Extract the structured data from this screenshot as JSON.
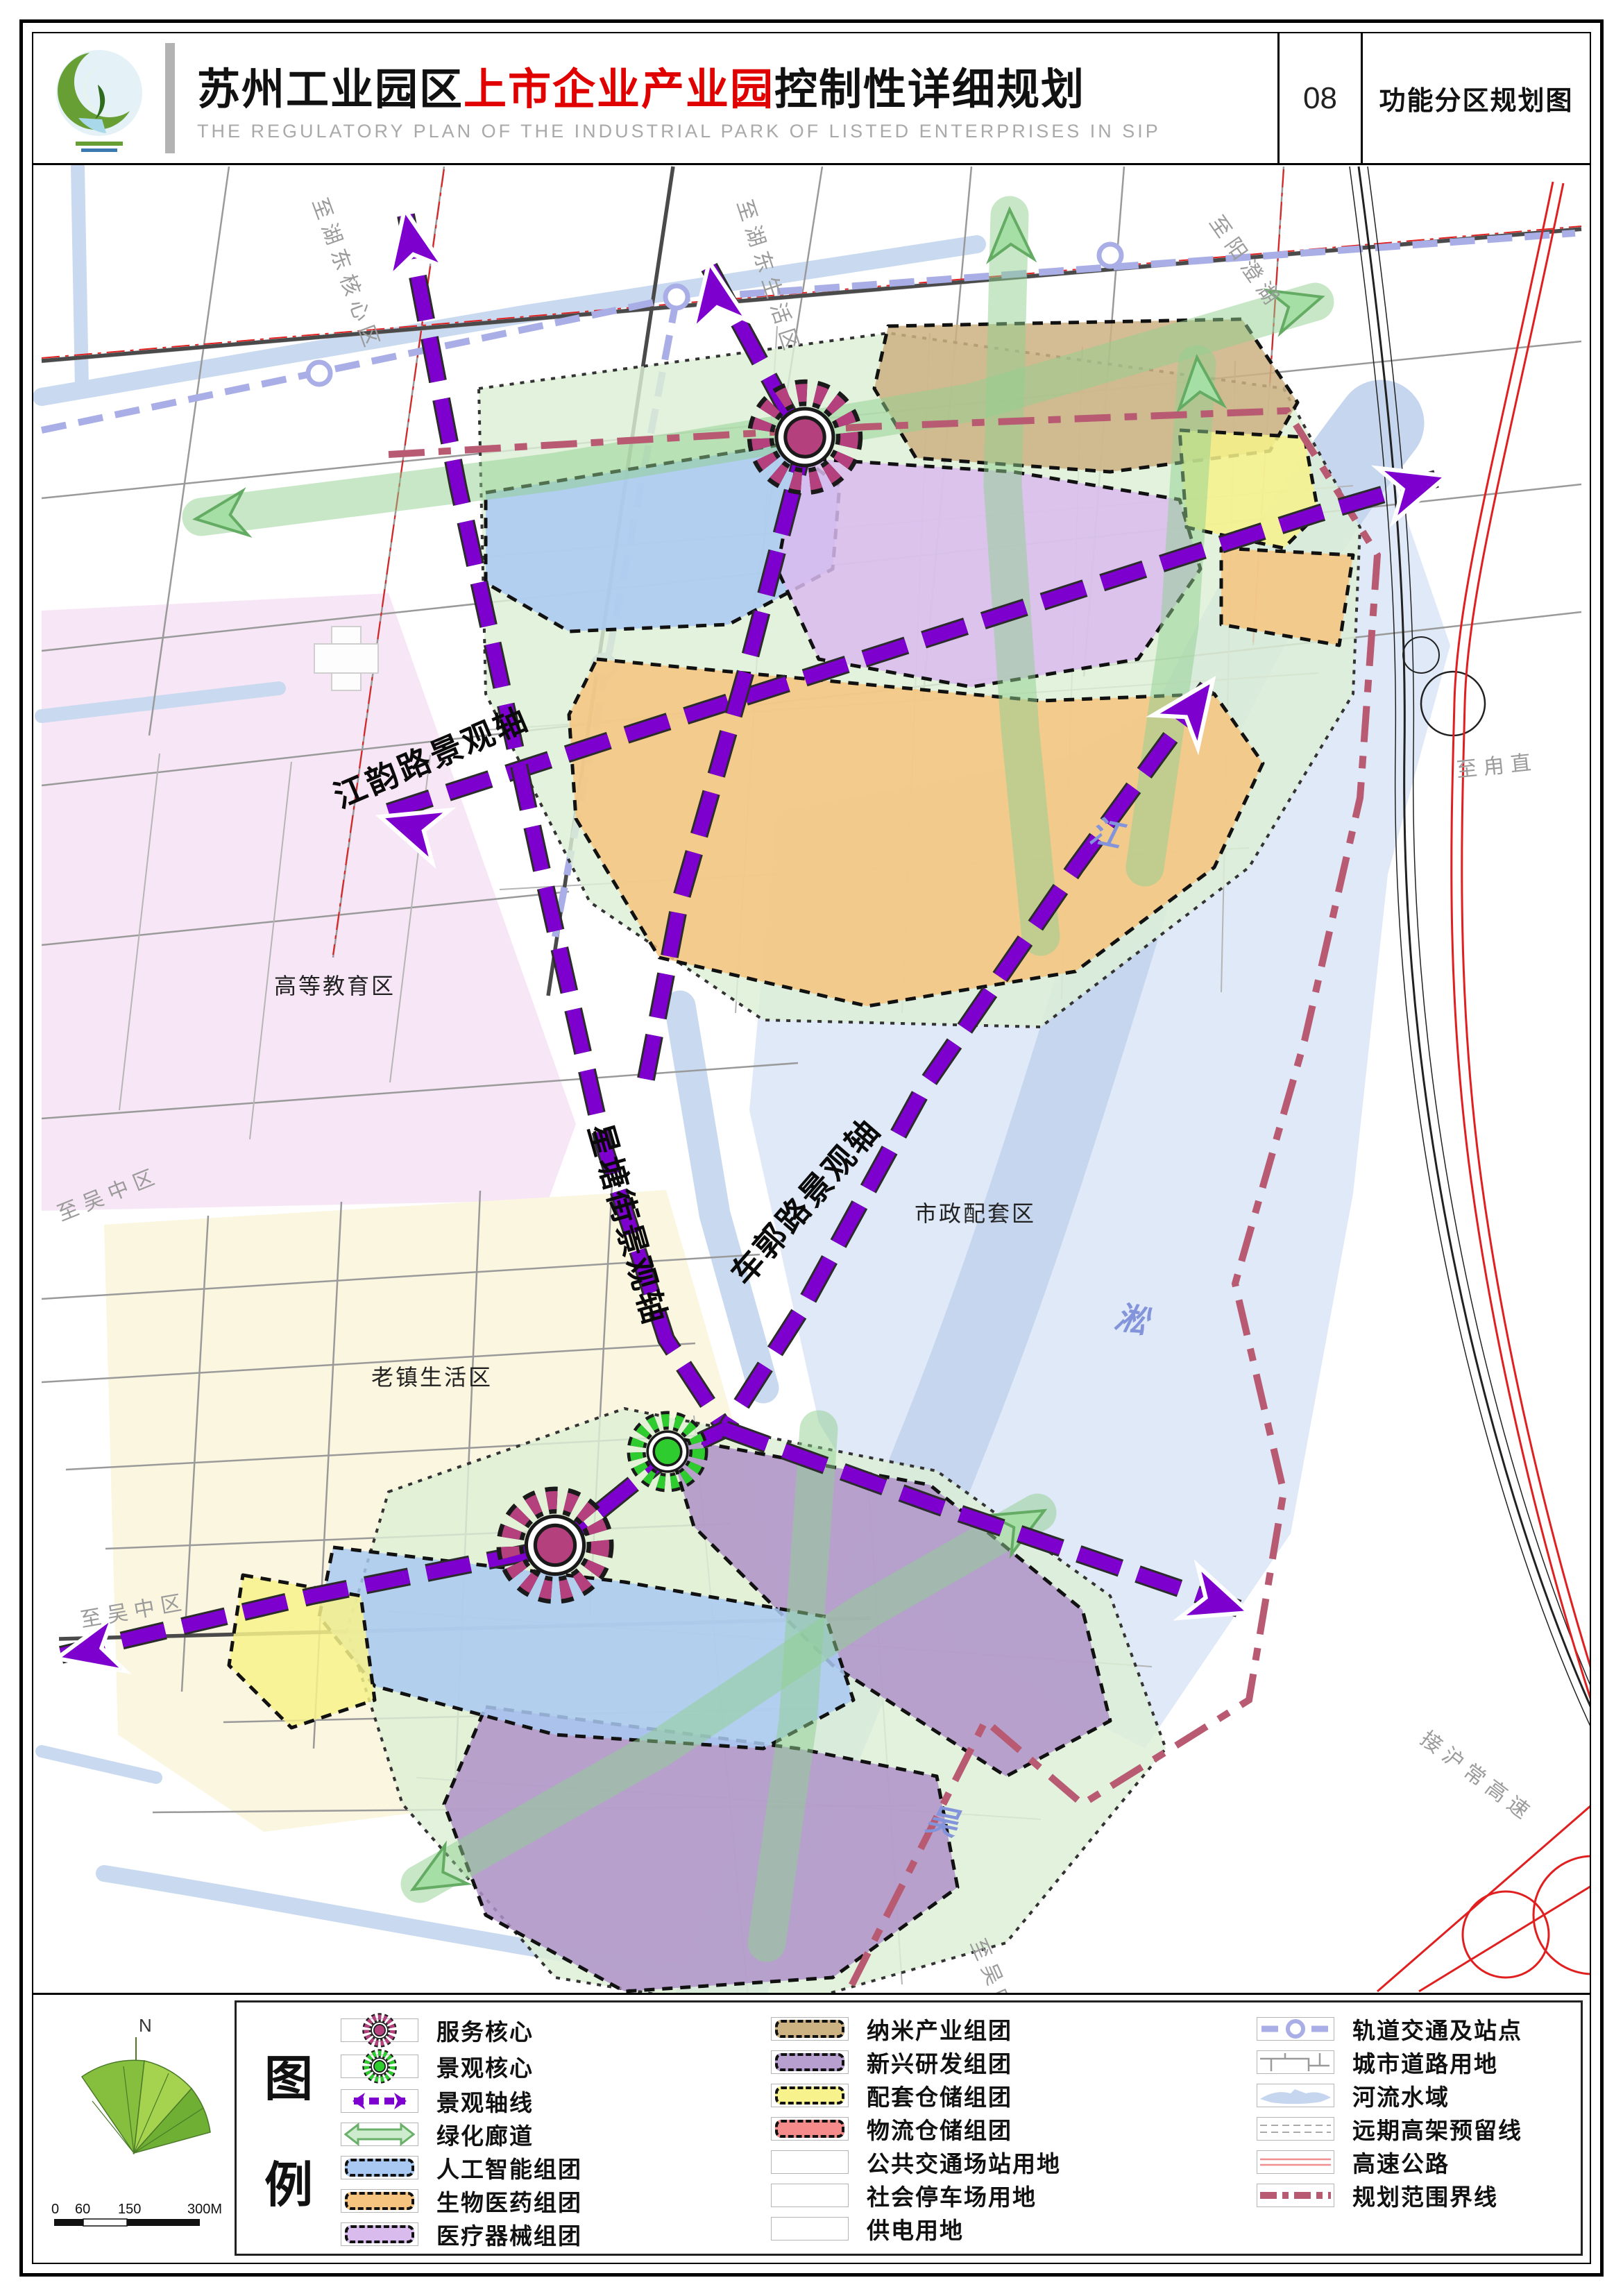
{
  "header": {
    "title_part1": "苏州工业园区",
    "title_part2": "上市企业产业园",
    "title_part3": "控制性详细规划",
    "subtitle": "THE REGULATORY PLAN OF THE INDUSTRIAL PARK OF LISTED ENTERPRISES IN SIP",
    "sheet_no": "08",
    "sheet_title": "功能分区规划图"
  },
  "map": {
    "axes": {
      "jiangyun": "江韵路景观轴",
      "xingtang": "星塘街景观轴",
      "cheguo": "车郭路景观轴"
    },
    "districts": {
      "education": "高等教育区",
      "old_town": "老镇生活区",
      "municipal": "市政配套区"
    },
    "edges": {
      "to_hudong_core": "至湖东核心区",
      "to_hudong_living": "至湖东生活区",
      "to_yangchenghu": "至阳澄湖",
      "to_luzhi": "至甪直",
      "to_wuzhong_1": "至吴中区",
      "to_wuzhong_2": "至吴中区",
      "to_wuzhong_3": "至吴中区",
      "to_huchang_expwy": "接沪常高速"
    },
    "river_name": {
      "char1": "江",
      "char2": "淞",
      "char3": "吴"
    }
  },
  "legend": {
    "title_top": "图",
    "title_bottom": "例",
    "col1": [
      {
        "label": "服务核心",
        "swatch": "gear",
        "color": "#b5407e"
      },
      {
        "label": "景观核心",
        "swatch": "gear",
        "color": "#2ecc2e"
      },
      {
        "label": "景观轴线",
        "swatch": "axis-arrow",
        "color": "#7e00cf"
      },
      {
        "label": "绿化廊道",
        "swatch": "green-corridor",
        "color": "#8fd08f"
      },
      {
        "label": "人工智能组团",
        "swatch": "patch",
        "color": "#a9c9f2"
      },
      {
        "label": "生物医药组团",
        "swatch": "patch",
        "color": "#f6c47e"
      },
      {
        "label": "医疗器械组团",
        "swatch": "patch",
        "color": "#d9bbee"
      }
    ],
    "col2": [
      {
        "label": "纳米产业组团",
        "swatch": "patch",
        "color": "#cdb282"
      },
      {
        "label": "新兴研发组团",
        "swatch": "patch",
        "color": "#b79fd0"
      },
      {
        "label": "配套仓储组团",
        "swatch": "patch",
        "color": "#f7f28b"
      },
      {
        "label": "物流仓储组团",
        "swatch": "patch",
        "color": "#f58b8b"
      },
      {
        "label": "公共交通场站用地",
        "swatch": "white",
        "color": "#ffffff"
      },
      {
        "label": "社会停车场用地",
        "swatch": "white",
        "color": "#ffffff"
      },
      {
        "label": "供电用地",
        "swatch": "white",
        "color": "#ffffff"
      }
    ],
    "col3": [
      {
        "label": "轨道交通及站点",
        "swatch": "rail",
        "color": "#a9afe6"
      },
      {
        "label": "城市道路用地",
        "swatch": "roads",
        "color": "#9a9a9a"
      },
      {
        "label": "河流水域",
        "swatch": "water",
        "color": "#c5d6ee"
      },
      {
        "label": "远期高架预留线",
        "swatch": "elevated",
        "color": "#aaaaaa"
      },
      {
        "label": "高速公路",
        "swatch": "expwy",
        "color": "#e02020"
      },
      {
        "label": "规划范围界线",
        "swatch": "boundary",
        "color": "#b85a72"
      }
    ],
    "scale": {
      "north": "N",
      "t0": "0",
      "t1": "60",
      "t2": "150",
      "t3": "300M"
    }
  },
  "colors": {
    "axis_purple": "#7e00cf",
    "corridor_green": "#8fd08f",
    "service_core_magenta": "#b5407e",
    "landscape_core_green": "#2ecc2e",
    "water_blue": "#c5d6ee",
    "municipal_pale_blue": "#dfe9f7",
    "education_pink": "#f7e6f5",
    "oldtown_cream": "#fbf6df",
    "boundary_darkred": "#b85a72",
    "expressway_red": "#e02020",
    "title_red": "#e00000"
  }
}
